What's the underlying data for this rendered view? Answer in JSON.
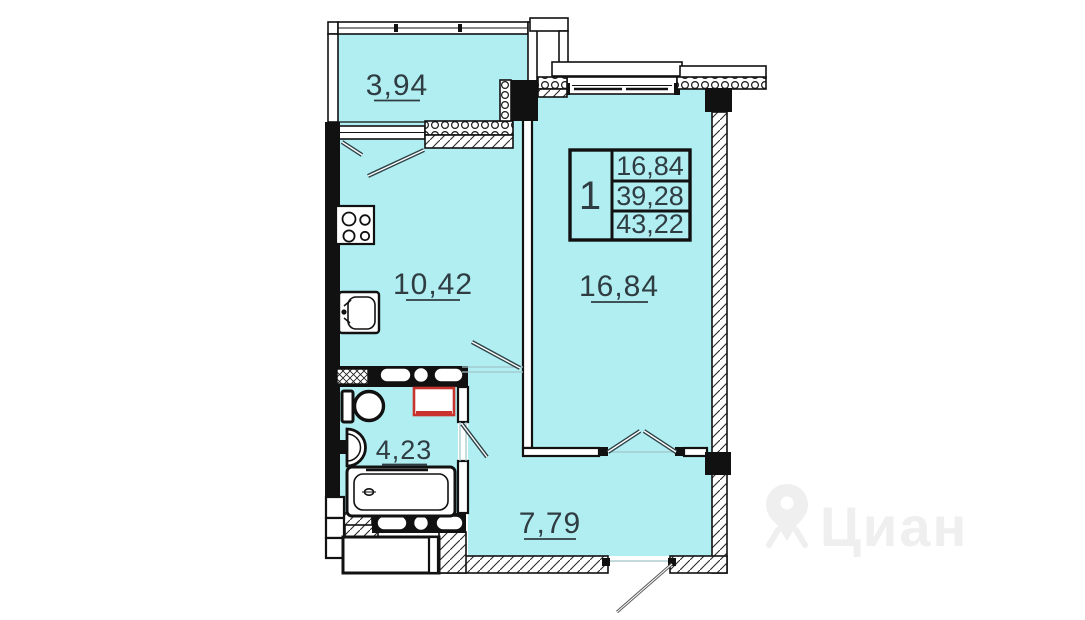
{
  "plan": {
    "type": "apartment-floor-plan",
    "rooms": {
      "balcony": {
        "label": "3,94"
      },
      "kitchen": {
        "label": "10,42"
      },
      "living": {
        "label": "16,84"
      },
      "bathroom": {
        "label": "4,23"
      },
      "hallway": {
        "label": "7,79"
      }
    },
    "info_table": {
      "rooms_count": "1",
      "living_area": "16,84",
      "area_without_balcony": "39,28",
      "total_area": "43,22"
    },
    "watermark": {
      "text": "Циан"
    },
    "colors": {
      "room_fill": "#b0eef2",
      "wall": "#111111",
      "label_text": "#2f3d42",
      "fixture_red": "#c8332e",
      "door_line": "#2e4348",
      "watermark": "#efefef"
    }
  }
}
